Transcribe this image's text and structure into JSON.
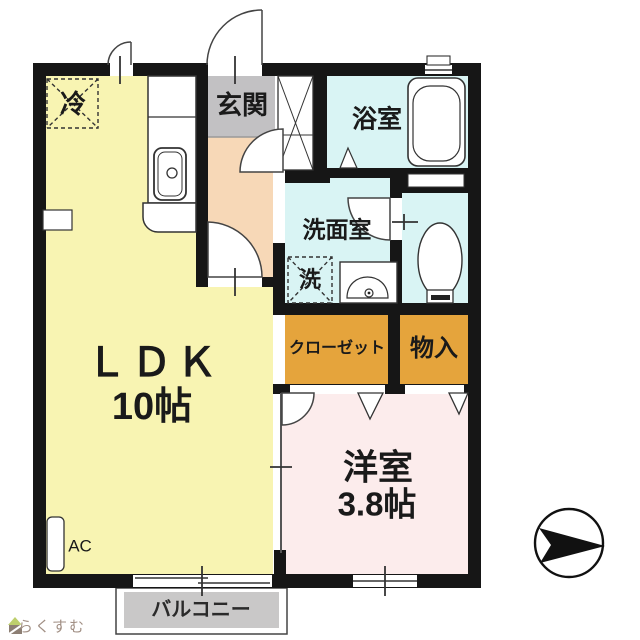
{
  "title": "1LDK apartment floor plan",
  "colors": {
    "wall": "#161616",
    "ldk": "#f8f4b2",
    "hall": "#f7d8b7",
    "genkan": "#c2c1c3",
    "wet": "#d9f4f4",
    "closet": "#e5a43c",
    "western": "#fcecec",
    "balcony": "#c9c8c8",
    "line": "#3a3a3a",
    "logo_text": "#a18f84",
    "logo_roof": "#becf6d",
    "logo_body": "#8d7f74"
  },
  "labels": {
    "refrigerator": "冷",
    "entrance": "玄関",
    "bathroom": "浴室",
    "washroom": "洗面室",
    "washer": "洗",
    "closet": "クローゼット",
    "storage": "物入",
    "ldk_name": "ＬＤＫ",
    "ldk_size": "10帖",
    "western_room_name": "洋室",
    "western_room_size": "3.8帖",
    "ac": "AC",
    "balcony": "バルコニー"
  },
  "logo": {
    "text": "らくすむ"
  }
}
